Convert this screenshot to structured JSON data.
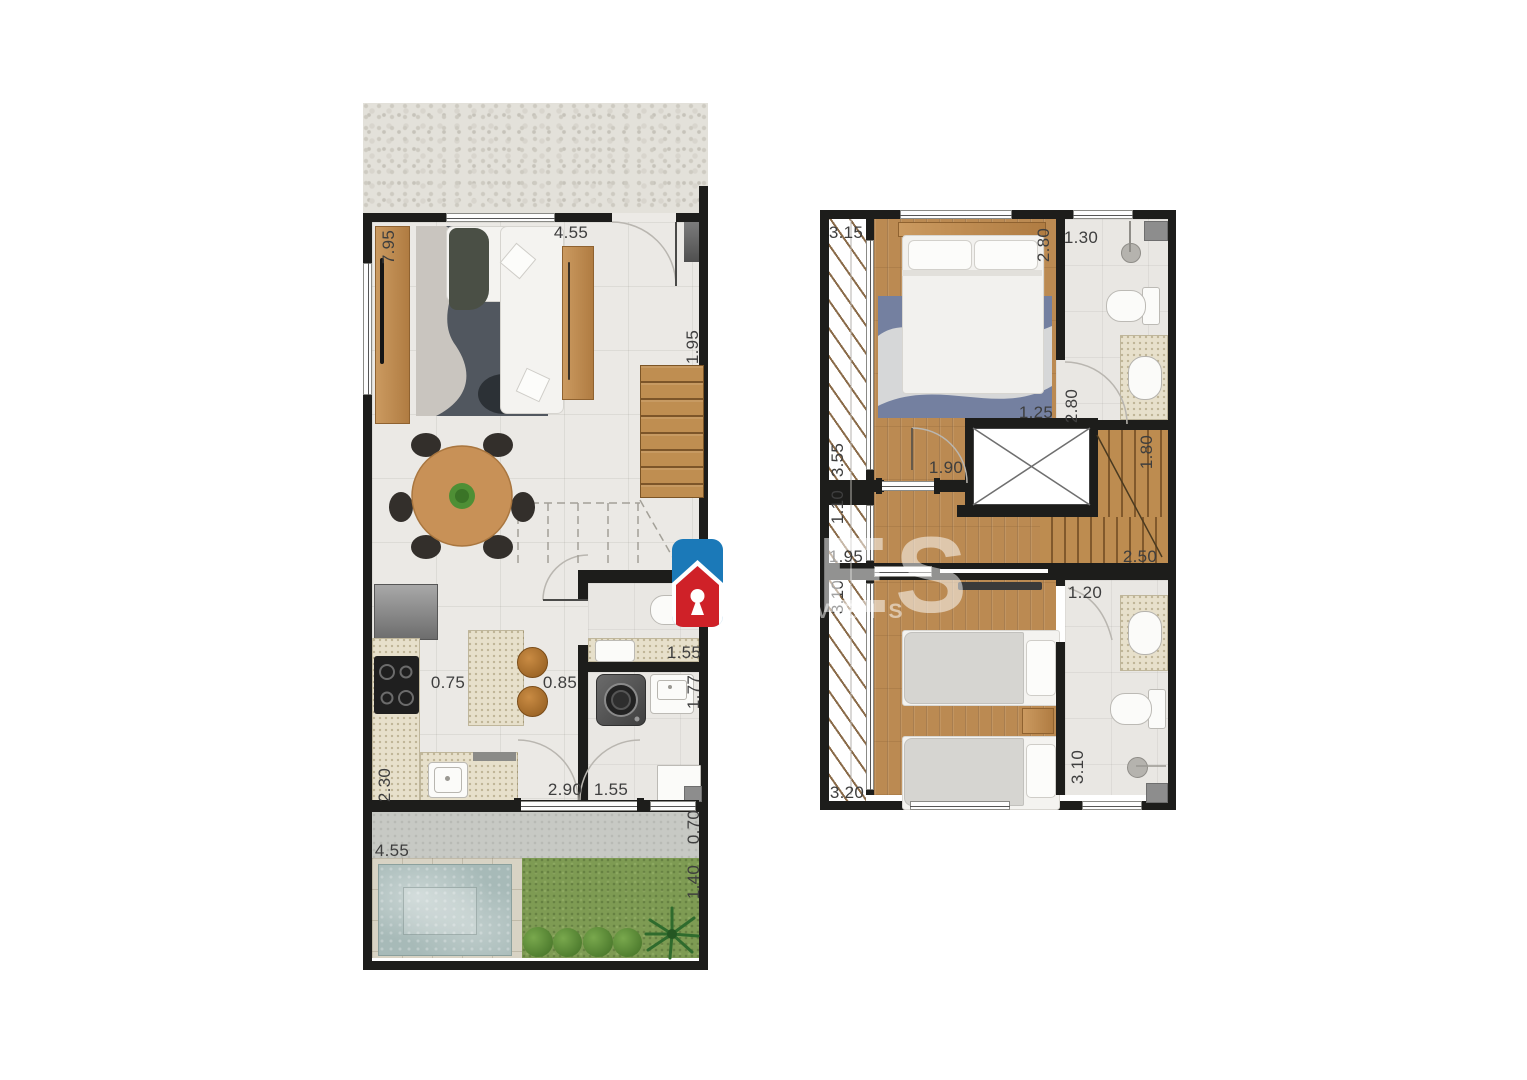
{
  "watermark": {
    "large_text": "RES",
    "small_text": "IMÓVEIS",
    "logo": "house-keyhole-icon",
    "colors": {
      "blue": "#1b79b8",
      "red": "#cf2128"
    }
  },
  "floors": [
    {
      "id": "ground_floor",
      "labels": [
        {
          "t": "7.95",
          "x": 389,
          "y": 247,
          "v": true
        },
        {
          "t": "4.55",
          "x": 571,
          "y": 233,
          "v": false
        },
        {
          "t": "1.95",
          "x": 693,
          "y": 347,
          "v": true
        },
        {
          "t": "0.75",
          "x": 448,
          "y": 683,
          "v": false
        },
        {
          "t": "0.85",
          "x": 560,
          "y": 683,
          "v": false
        },
        {
          "t": "1.55",
          "x": 684,
          "y": 653,
          "v": false
        },
        {
          "t": "1.77",
          "x": 694,
          "y": 692,
          "v": true
        },
        {
          "t": "2.30",
          "x": 385,
          "y": 785,
          "v": true
        },
        {
          "t": "2.90",
          "x": 565,
          "y": 790,
          "v": false
        },
        {
          "t": "1.55",
          "x": 611,
          "y": 790,
          "v": false
        },
        {
          "t": "0.70",
          "x": 694,
          "y": 827,
          "v": true
        },
        {
          "t": "4.55",
          "x": 392,
          "y": 851,
          "v": false
        },
        {
          "t": "1.40",
          "x": 694,
          "y": 882,
          "v": true
        }
      ]
    },
    {
      "id": "upper_floor",
      "labels": [
        {
          "t": "3.15",
          "x": 846,
          "y": 233,
          "v": false
        },
        {
          "t": "2.80",
          "x": 1044,
          "y": 245,
          "v": true
        },
        {
          "t": "1.30",
          "x": 1081,
          "y": 238,
          "v": false
        },
        {
          "t": "1.25",
          "x": 1036,
          "y": 413,
          "v": false
        },
        {
          "t": "2.80",
          "x": 1072,
          "y": 406,
          "v": true
        },
        {
          "t": "3.55",
          "x": 838,
          "y": 460,
          "v": true
        },
        {
          "t": "1.90",
          "x": 946,
          "y": 468,
          "v": false
        },
        {
          "t": "1.80",
          "x": 1147,
          "y": 452,
          "v": true
        },
        {
          "t": "1.10",
          "x": 838,
          "y": 507,
          "v": true
        },
        {
          "t": "1.95",
          "x": 846,
          "y": 557,
          "v": false
        },
        {
          "t": "2.50",
          "x": 1140,
          "y": 557,
          "v": false
        },
        {
          "t": "3.10",
          "x": 838,
          "y": 597,
          "v": true
        },
        {
          "t": "1.20",
          "x": 1085,
          "y": 593,
          "v": false
        },
        {
          "t": "3.10",
          "x": 1078,
          "y": 767,
          "v": true
        },
        {
          "t": "3.20",
          "x": 847,
          "y": 793,
          "v": false
        }
      ]
    }
  ]
}
